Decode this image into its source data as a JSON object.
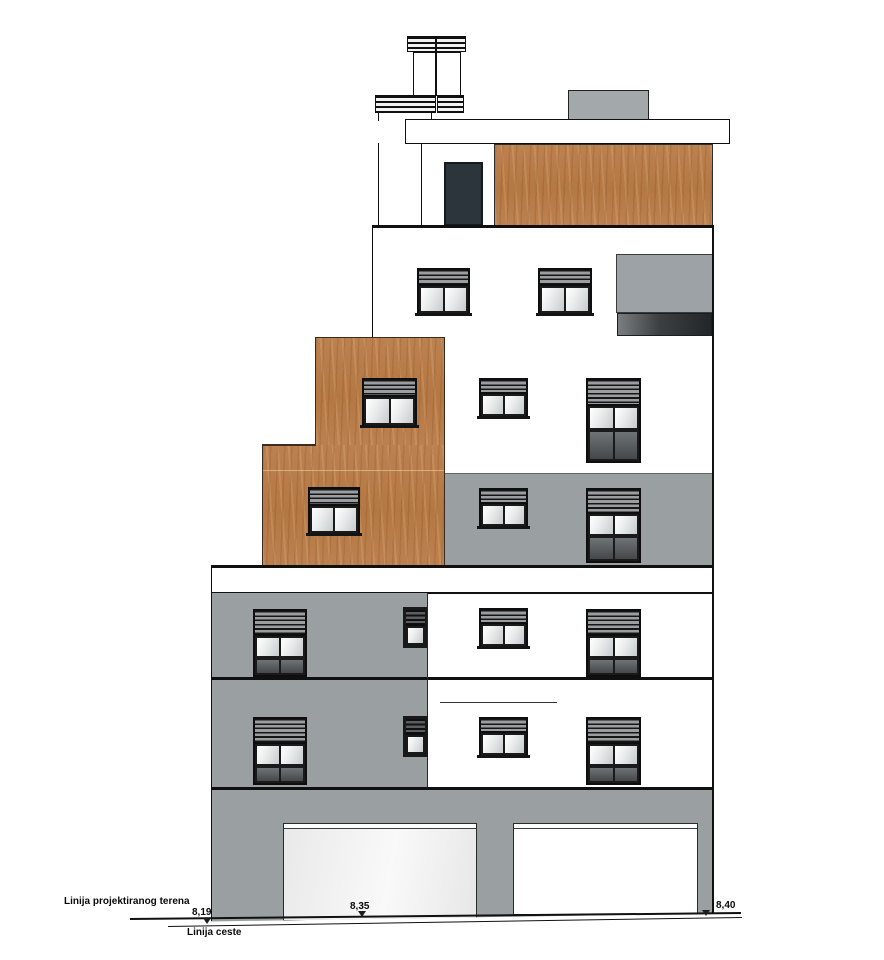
{
  "annotations": {
    "terrain_line_label": "Linija projektiranog terena",
    "road_line_label": "Linija ceste",
    "elevations": {
      "left": "8,19",
      "center": "8,35",
      "right": "8,40"
    }
  },
  "colors": {
    "facade_gray": "#9aa0a2",
    "roof_panel_gray": "#a3a8aa",
    "wood_cladding": "#b87c4a",
    "door_dark": "#2b353b",
    "outline": "#111111",
    "background": "#ffffff"
  }
}
